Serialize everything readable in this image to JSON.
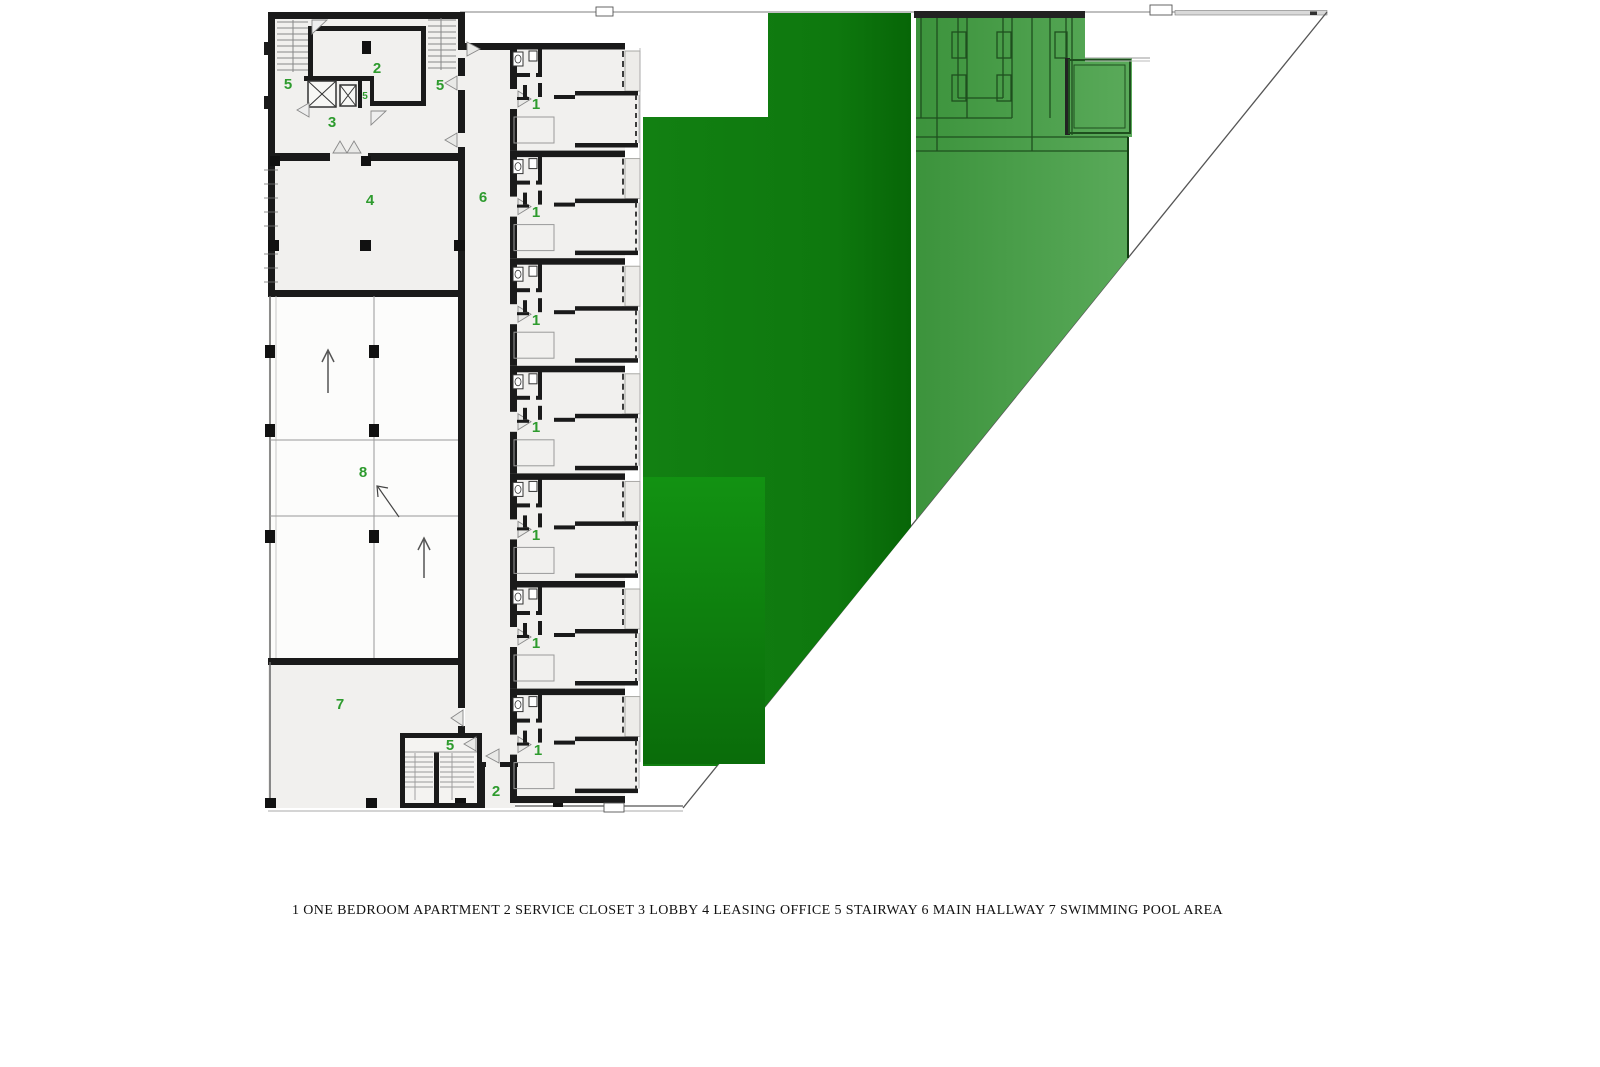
{
  "plan": {
    "rooms": {
      "stairway_top_left": "5",
      "service_closet_top": "2",
      "stairway_top_right": "5",
      "stairway_core": "5",
      "lobby": "3",
      "leasing_office": "4",
      "main_hallway": "6",
      "ramp_area": "8",
      "swimming_pool": "7",
      "stairway_bottom": "5",
      "service_closet_bottom": "2",
      "apartments": [
        "1",
        "1",
        "1",
        "1",
        "1",
        "1",
        "1"
      ]
    },
    "colors": {
      "label_green": "#2e9b2e",
      "landscape_green": "#117e11",
      "landscape_green_dark": "#076607",
      "landscape_green_roof_light": "#5aaa5a",
      "landscape_green_roof": "#3c933c",
      "courtyard_green_top": "#129212",
      "courtyard_green_bottom": "#0a6c0a",
      "wall": "#1a1a1a",
      "floor_fill": "#f1f0ee"
    }
  },
  "legend": {
    "text": "1 ONE BEDROOM APARTMENT 2 SERVICE CLOSET 3 LOBBY 4 LEASING OFFICE 5 STAIRWAY 6 MAIN HALLWAY 7 SWIMMING POOL AREA",
    "items": [
      {
        "number": "1",
        "label": "ONE BEDROOM APARTMENT"
      },
      {
        "number": "2",
        "label": "SERVICE CLOSET"
      },
      {
        "number": "3",
        "label": "LOBBY"
      },
      {
        "number": "4",
        "label": "LEASING OFFICE"
      },
      {
        "number": "5",
        "label": "STAIRWAY"
      },
      {
        "number": "6",
        "label": "MAIN HALLWAY"
      },
      {
        "number": "7",
        "label": "SWIMMING POOL AREA"
      }
    ]
  }
}
